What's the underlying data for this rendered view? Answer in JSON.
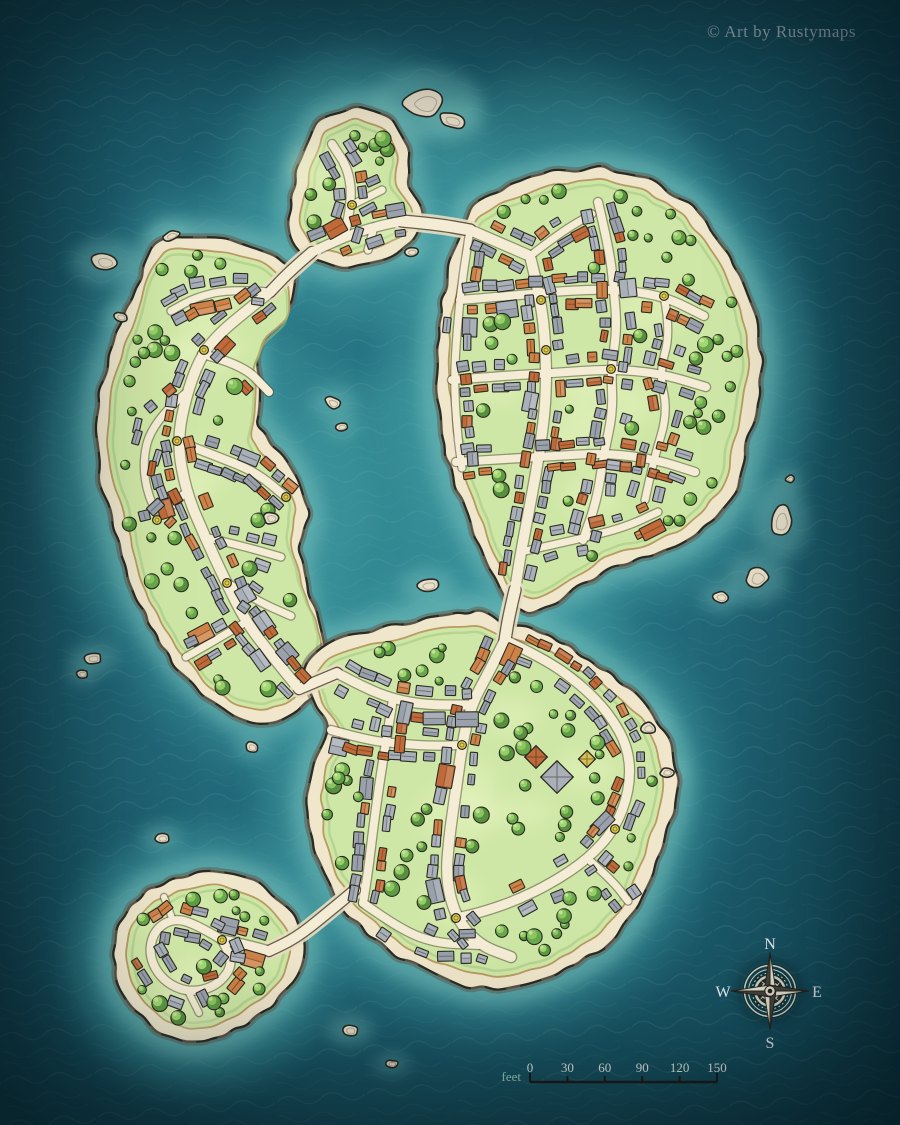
{
  "attribution": "© Art by Rustymaps",
  "compass": {
    "n": "N",
    "e": "E",
    "s": "S",
    "w": "W"
  },
  "scale_bar": {
    "unit": "feet",
    "ticks": [
      "0",
      "30",
      "60",
      "90",
      "120",
      "150"
    ]
  },
  "colors": {
    "water_deep": "#0c3643",
    "water_mid": "#226879",
    "water_shallow": "#7cc6c0",
    "water_glow": "#3f98a0",
    "shore_sand": "#efe6cb",
    "cliff": "#5f574a",
    "grass": "#cfe7a6",
    "grass_edge": "#b99b63",
    "grass_rim": "#9fc37c",
    "road": "#f4ecd4",
    "road_edge": "#4d4636",
    "sand_causeway": "#e8dec1",
    "roof_gray": "#9aa1ab",
    "roof_gray_light": "#aab0b8",
    "roof_terracotta": "#bf6a38",
    "roof_terracotta_light": "#cd8348",
    "roof_yellow": "#d8c052",
    "tree_green": "#69a94b",
    "tree_light": "#a8d977",
    "marker_yellow": "#e3cf4e",
    "rock": "#e7dfc9",
    "ink": "#2b2a23",
    "attribution_text": "#b5bfc7",
    "scale_text": "#e9f2ec",
    "scale_unit_text": "#a9d8cd",
    "compass_metal": "#ddd8c9"
  }
}
